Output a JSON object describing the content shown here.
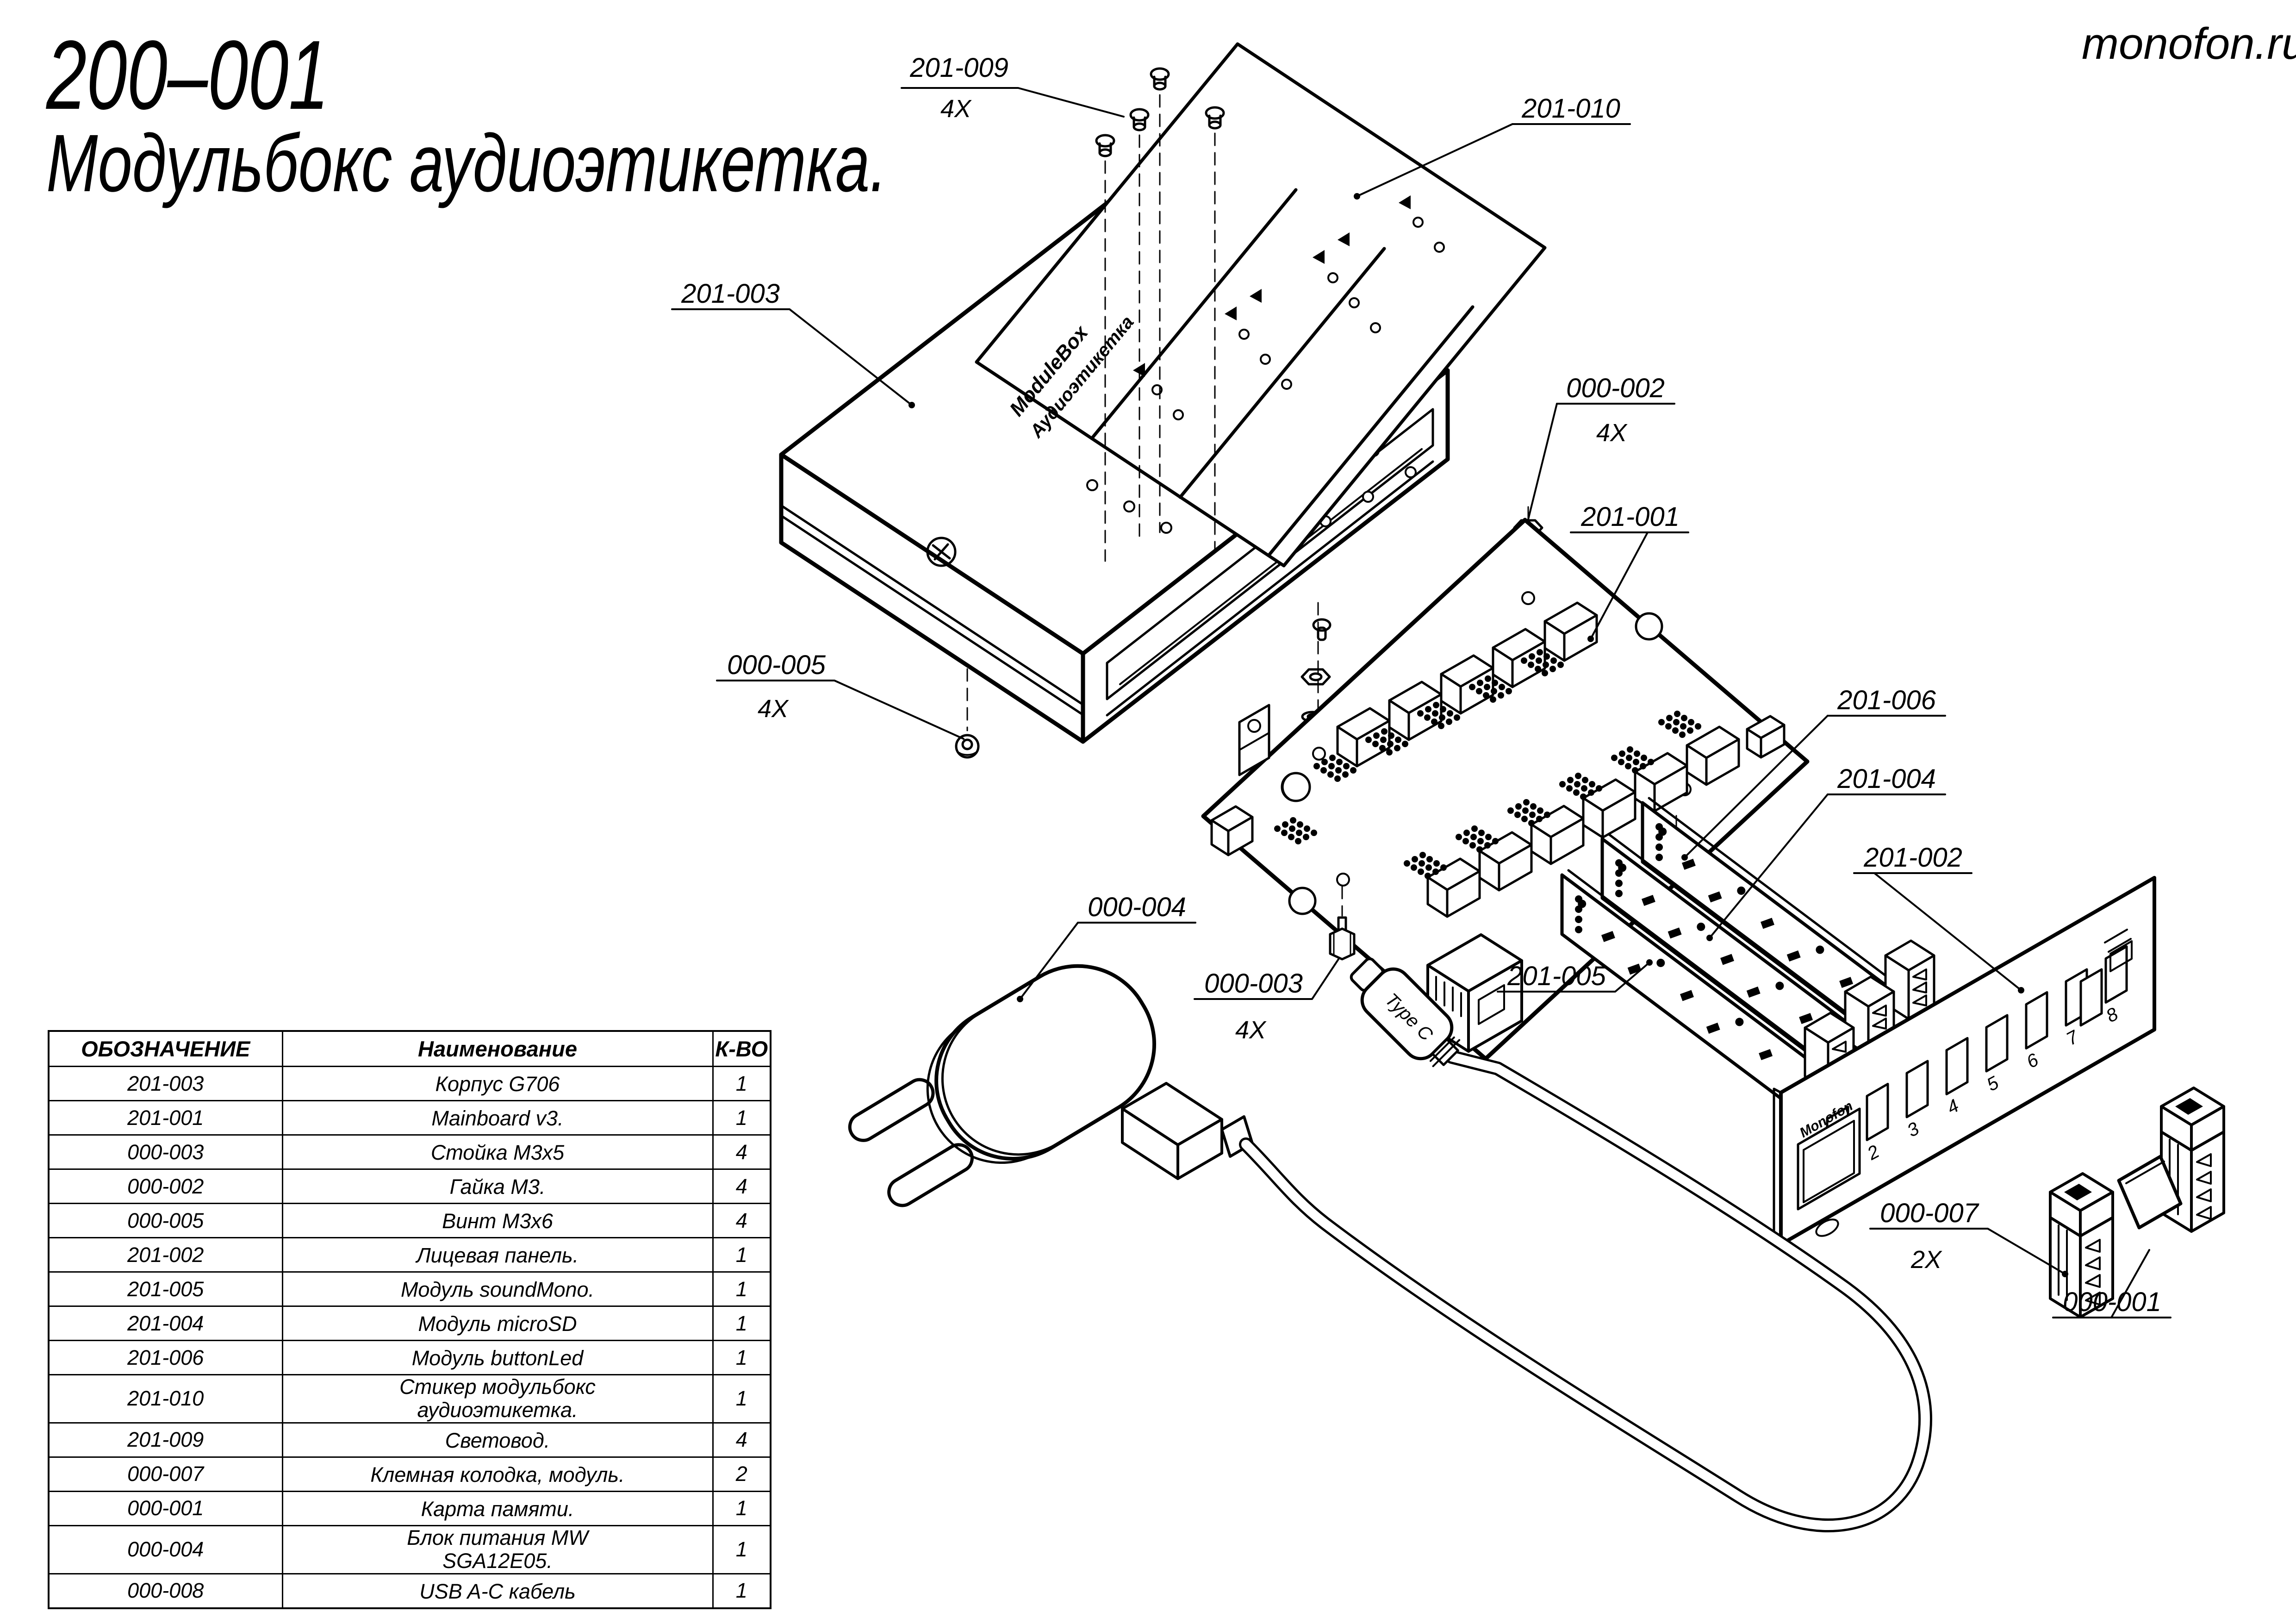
{
  "colors": {
    "ink": "#000000",
    "paper": "#ffffff"
  },
  "title": {
    "part_number": "200–001",
    "name": "Модульбокс аудиоэтикетка."
  },
  "watermark": "monofon.ru",
  "callouts": {
    "c201_009": {
      "label": "201-009",
      "qty": "4X"
    },
    "c201_010": {
      "label": "201-010"
    },
    "c201_003": {
      "label": "201-003"
    },
    "c000_002": {
      "label": "000-002",
      "qty": "4X"
    },
    "c201_001": {
      "label": "201-001"
    },
    "c000_005": {
      "label": "000-005",
      "qty": "4X"
    },
    "c201_006": {
      "label": "201-006"
    },
    "c201_004": {
      "label": "201-004"
    },
    "c201_002": {
      "label": "201-002"
    },
    "c000_004": {
      "label": "000-004"
    },
    "c000_003": {
      "label": "000-003",
      "qty": "4X"
    },
    "c201_005": {
      "label": "201-005"
    },
    "c000_007": {
      "label": "000-007",
      "qty": "2X"
    },
    "c000_001": {
      "label": "000-001"
    }
  },
  "sticker": {
    "line1": "ModuleBox",
    "line2": "Аудиоэтикетка"
  },
  "front_panel": {
    "logo": "Monofon",
    "slot_numbers": [
      "1",
      "2",
      "3",
      "4",
      "5",
      "6",
      "7",
      "8"
    ]
  },
  "cable": {
    "connector_label": "Type C"
  },
  "table": {
    "headers": [
      "ОБОЗНАЧЕНИЕ",
      "Наименование",
      "К-ВО"
    ],
    "rows": [
      [
        "201-003",
        "Корпус G706",
        "1"
      ],
      [
        "201-001",
        "Mainboard v3.",
        "1"
      ],
      [
        "000-003",
        "Стойка М3х5",
        "4"
      ],
      [
        "000-002",
        "Гайка М3.",
        "4"
      ],
      [
        "000-005",
        "Винт М3х6",
        "4"
      ],
      [
        "201-002",
        "Лицевая панель.",
        "1"
      ],
      [
        "201-005",
        "Модуль soundMono.",
        "1"
      ],
      [
        "201-004",
        "Модуль microSD",
        "1"
      ],
      [
        "201-006",
        "Модуль buttonLed",
        "1"
      ],
      [
        "201-010",
        "Стикер модульбокс аудиоэтикетка.",
        "1"
      ],
      [
        "201-009",
        "Световод.",
        "4"
      ],
      [
        "000-007",
        "Клемная колодка, модуль.",
        "2"
      ],
      [
        "000-001",
        "Карта памяти.",
        "1"
      ],
      [
        "000-004",
        "Блок питания MW SGA12E05.",
        "1"
      ],
      [
        "000-008",
        "USB A-C кабель",
        "1"
      ]
    ]
  }
}
